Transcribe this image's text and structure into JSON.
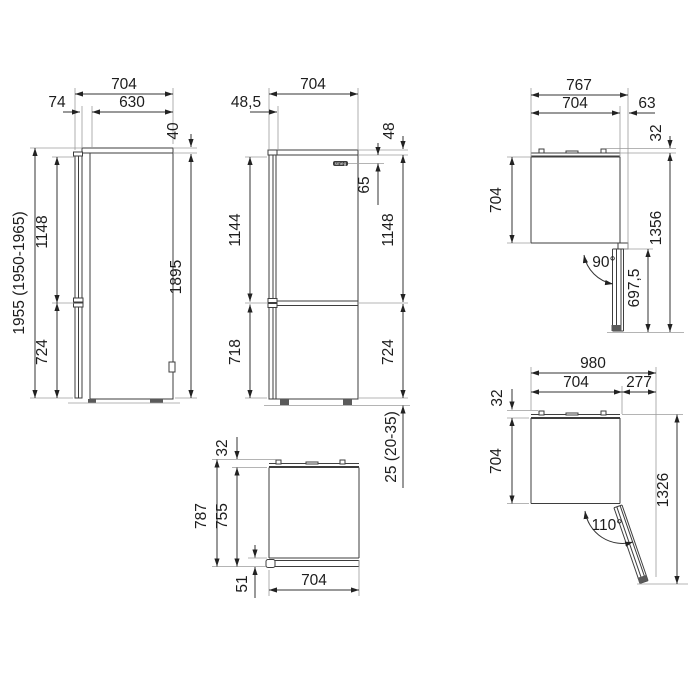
{
  "drawing": {
    "brand_logo": "smeg",
    "views": {
      "side": {
        "depth_total": "704",
        "door_gap": "74",
        "body_depth": "630",
        "lid_height": "40",
        "height_total": "1955 (1950-1965)",
        "upper_door_height": "1148",
        "lower_door_height": "724",
        "body_height": "1895"
      },
      "front": {
        "width": "704",
        "hinge_offset": "48,5",
        "top_band": "48",
        "logo_offset": "65",
        "upper_door_left": "1144",
        "upper_door_right": "1148",
        "lower_door_left": "718",
        "lower_door_right": "724",
        "feet_height": "25 (20-35)",
        "logo": "smeg"
      },
      "top_open_90": {
        "width_total": "767",
        "width_body": "704",
        "hinge_overhang": "63",
        "rear_spacer": "32",
        "depth_body": "704",
        "depth_open": "1356",
        "door_length": "697,5",
        "angle": "90°"
      },
      "top_closed": {
        "rear_spacer": "32",
        "depth_total": "787",
        "depth_body": "755",
        "door_clearance": "51",
        "width": "704"
      },
      "top_open_110": {
        "width_total": "980",
        "width_body": "704",
        "door_swing": "277",
        "rear_spacer": "32",
        "depth_body": "704",
        "depth_open": "1326",
        "angle": "110°"
      }
    }
  }
}
